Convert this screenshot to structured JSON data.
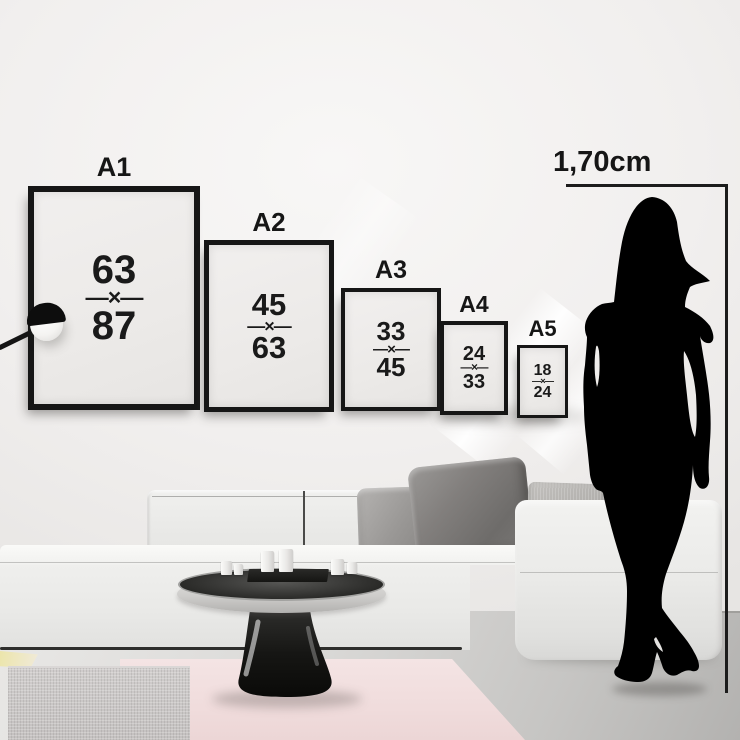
{
  "measure": {
    "label": "1,70cm"
  },
  "frames": [
    {
      "label": "A1",
      "width_value": "63",
      "separator": "—×—",
      "height_value": "87"
    },
    {
      "label": "A2",
      "width_value": "45",
      "separator": "—×—",
      "height_value": "63"
    },
    {
      "label": "A3",
      "width_value": "33",
      "separator": "—×—",
      "height_value": "45"
    },
    {
      "label": "A4",
      "width_value": "24",
      "separator": "—×—",
      "height_value": "33"
    },
    {
      "label": "A5",
      "width_value": "18",
      "separator": "—×—",
      "height_value": "24"
    }
  ],
  "colors": {
    "frame_border": "#161616",
    "annotation_line": "#1c1c1c",
    "wall": "#efedec",
    "floor": "#c6c5c3",
    "sofa": "#ededeb",
    "rug_pink": "#f2e0e0",
    "rug_gray": "#c6c3c2",
    "rug_yellow": "#ece5ab",
    "silhouette": "#000000"
  }
}
